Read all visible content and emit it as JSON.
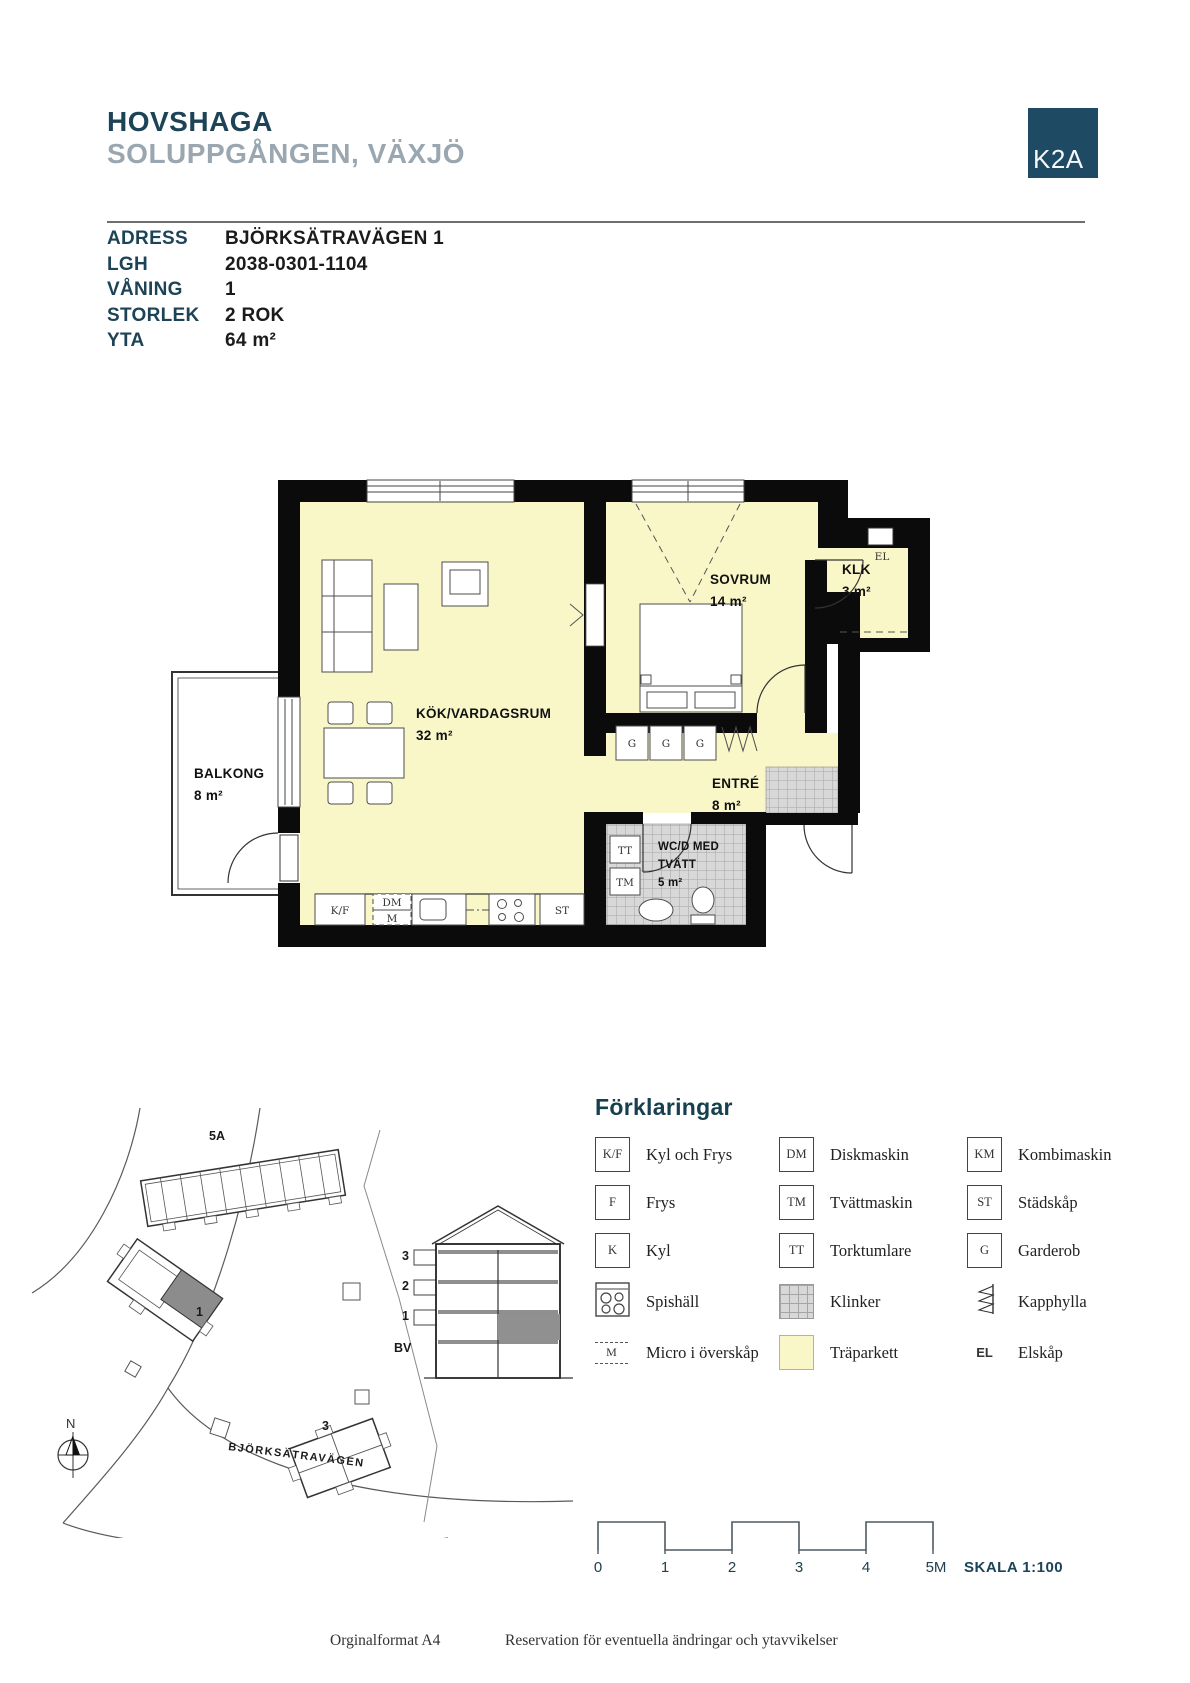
{
  "header": {
    "title": "HOVSHAGA",
    "subtitle": "SOLUPPGÅNGEN, VÄXJÖ",
    "logo_text": "K2A"
  },
  "info": {
    "rows": [
      {
        "label": "ADRESS",
        "value": "BJÖRKSÄTRAVÄGEN 1"
      },
      {
        "label": "LGH",
        "value": "2038-0301-1104"
      },
      {
        "label": "VÅNING",
        "value": "1"
      },
      {
        "label": "STORLEK",
        "value": "2 ROK"
      },
      {
        "label": "YTA",
        "value": "64 m²"
      }
    ]
  },
  "floorplan": {
    "rooms": {
      "kitchen_living": {
        "name": "KÖK/VARDAGSRUM",
        "area": "32 m²"
      },
      "bedroom": {
        "name": "SOVRUM",
        "area": "14 m²"
      },
      "balcony": {
        "name": "BALKONG",
        "area": "8 m²"
      },
      "closet": {
        "name": "KLK",
        "area": "3 m²"
      },
      "hall": {
        "name": "ENTRÉ",
        "area": "8 m²"
      },
      "bathroom": {
        "name_line1": "WC/D MED",
        "name_line2": "TVÄTT",
        "area": "5 m²"
      }
    },
    "markers": {
      "kf": "K/F",
      "dm": "DM",
      "m": "M",
      "st": "ST",
      "tt": "TT",
      "tm": "TM",
      "g": "G",
      "el": "EL"
    }
  },
  "siteplan": {
    "labels": {
      "building_5a": "5A",
      "building_1": "1",
      "building_3": "3",
      "road": "BJÖRKSÄTRAVÄGEN",
      "compass": "N"
    },
    "section_floors": [
      "3",
      "2",
      "1",
      "BV"
    ]
  },
  "legend": {
    "title": "Förklaringar",
    "items": [
      {
        "symbol": "K/F",
        "label": "Kyl och Frys",
        "type": "box"
      },
      {
        "symbol": "DM",
        "label": "Diskmaskin",
        "type": "box"
      },
      {
        "symbol": "KM",
        "label": "Kombimaskin",
        "type": "box"
      },
      {
        "symbol": "F",
        "label": "Frys",
        "type": "box"
      },
      {
        "symbol": "TM",
        "label": "Tvättmaskin",
        "type": "box"
      },
      {
        "symbol": "ST",
        "label": "Städskåp",
        "type": "box"
      },
      {
        "symbol": "K",
        "label": "Kyl",
        "type": "box"
      },
      {
        "symbol": "TT",
        "label": "Torktumlare",
        "type": "box"
      },
      {
        "symbol": "G",
        "label": "Garderob",
        "type": "box"
      },
      {
        "symbol": "",
        "label": "Spishäll",
        "type": "stove"
      },
      {
        "symbol": "",
        "label": "Klinker",
        "type": "klinker"
      },
      {
        "symbol": "",
        "label": "Kapphylla",
        "type": "kapphylla"
      },
      {
        "symbol": "M",
        "label": "Micro i överskåp",
        "type": "micro"
      },
      {
        "symbol": "",
        "label": "Träparkett",
        "type": "parquet"
      },
      {
        "symbol": "EL",
        "label": "Elskåp",
        "type": "el"
      }
    ]
  },
  "scalebar": {
    "ticks": [
      "0",
      "1",
      "2",
      "3",
      "4",
      "5M"
    ],
    "label": "SKALA 1:100"
  },
  "footer": {
    "left": "Orginalformat A4",
    "right": "Reservation för eventuella ändringar och ytavvikelser"
  },
  "colors": {
    "navy": "#1d4356",
    "subtitle_gray": "#9aa7b0",
    "logo_bg": "#1e4b63",
    "parquet": "#f9f6c8",
    "klinker": "#d8d8d8"
  }
}
